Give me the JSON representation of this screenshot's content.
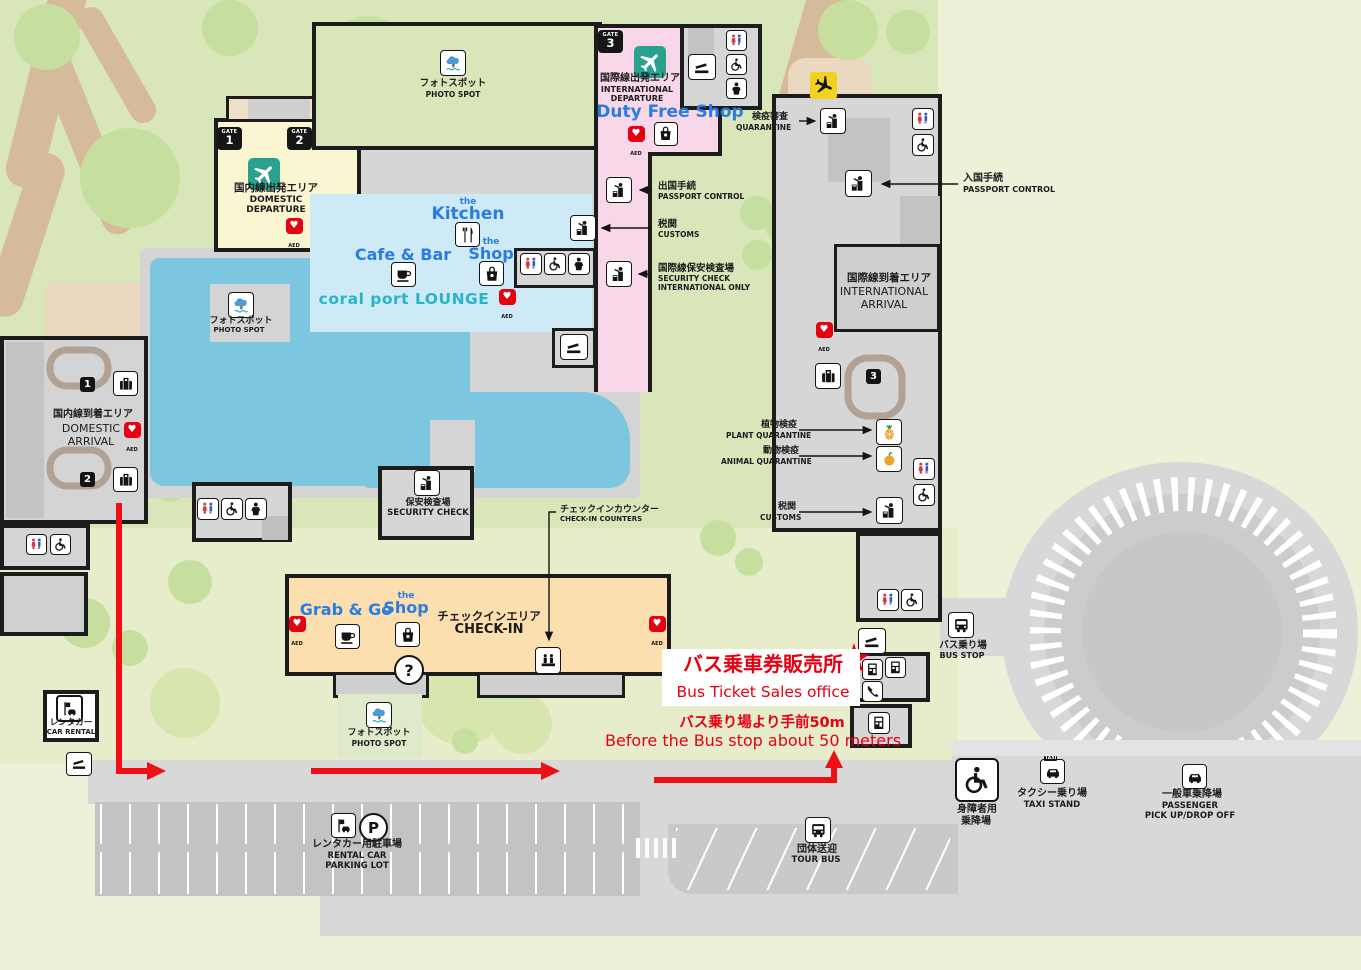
{
  "map_title": "Airport terminal floor map",
  "glyphs": {
    "gate": "GATE",
    "parking": "P",
    "question": "?",
    "taxi_sign": "TAXI",
    "star": "★",
    "heart": "♥"
  },
  "gates": {
    "g1": "1",
    "g2": "2",
    "g3": "3"
  },
  "belts": {
    "b1": "1",
    "b2": "2",
    "b3": "3"
  },
  "aed": "AED",
  "areas": {
    "domestic_departure": {
      "jp": "国内線出発エリア",
      "en1": "DOMESTIC",
      "en2": "DEPARTURE"
    },
    "international_departure": {
      "jp": "国際線出発エリア",
      "en1": "INTERNATIONAL",
      "en2": "DEPARTURE"
    },
    "duty_free": "Duty Free Shop",
    "international_arrival": {
      "jp": "国際線到着エリア",
      "en1": "INTERNATIONAL",
      "en2": "ARRIVAL"
    },
    "domestic_arrival": {
      "jp": "国内線到着エリア",
      "en1": "DOMESTIC",
      "en2": "ARRIVAL"
    },
    "checkin": {
      "jp": "チェックインエリア",
      "en": "CHECK-IN"
    },
    "security": {
      "jp": "保安検査場",
      "en": "SECURITY CHECK"
    }
  },
  "shops": {
    "kitchen_pre": "the",
    "kitchen": "Kitchen",
    "cafe": "Cafe & Bar",
    "shop_pre": "the",
    "shop": "Shop",
    "lounge": "coral port  LOUNGE",
    "grab": "Grab & Go"
  },
  "poi": {
    "photo_jp": "フォトスポット",
    "photo_en": "PHOTO SPOT",
    "quarantine_jp": "検疫審査",
    "quarantine_en": "QUARANTINE",
    "entry_jp": "入国手続",
    "entry_en": "PASSPORT CONTROL",
    "exit_jp": "出国手続",
    "exit_en": "PASSPORT CONTROL",
    "customs_jp": "税関",
    "customs_en": "CUSTOMS",
    "secintl_jp": "国際線保安検査場",
    "secintl_en1": "SECURITY CHECK",
    "secintl_en2": "INTERNATIONAL ONLY",
    "plant_jp": "植物検疫",
    "plant_en": "PLANT QUARANTINE",
    "animal_jp": "動物検疫",
    "animal_en": "ANIMAL QUARANTINE",
    "counter_jp": "チェックインカウンター",
    "counter_en": "CHECK-IN COUNTERS"
  },
  "bus_office": {
    "jp": "バス乗車券販売所",
    "en": "Bus Ticket Sales office",
    "note_jp": "バス乗り場より手前50m",
    "note_en": "Before the Bus stop about 50 meters"
  },
  "transport": {
    "bus_stop_jp": "バス乗り場",
    "bus_stop_en": "BUS STOP",
    "car_rental_jp": "レンタカー",
    "car_rental_en": "CAR RENTAL",
    "parking_jp": "レンタカー用駐車場",
    "parking_en1": "RENTAL CAR",
    "parking_en2": "PARKING LOT",
    "tour_jp": "団体送迎",
    "tour_en": "TOUR BUS",
    "handicap_jp1": "身障者用",
    "handicap_jp2": "乗降場",
    "taxi_jp": "タクシー乗り場",
    "taxi_en": "TAXI STAND",
    "passenger_jp": "一般車乗降場",
    "passenger_en1": "PASSENGER",
    "passenger_en2": "PICK UP/DROP OFF"
  }
}
